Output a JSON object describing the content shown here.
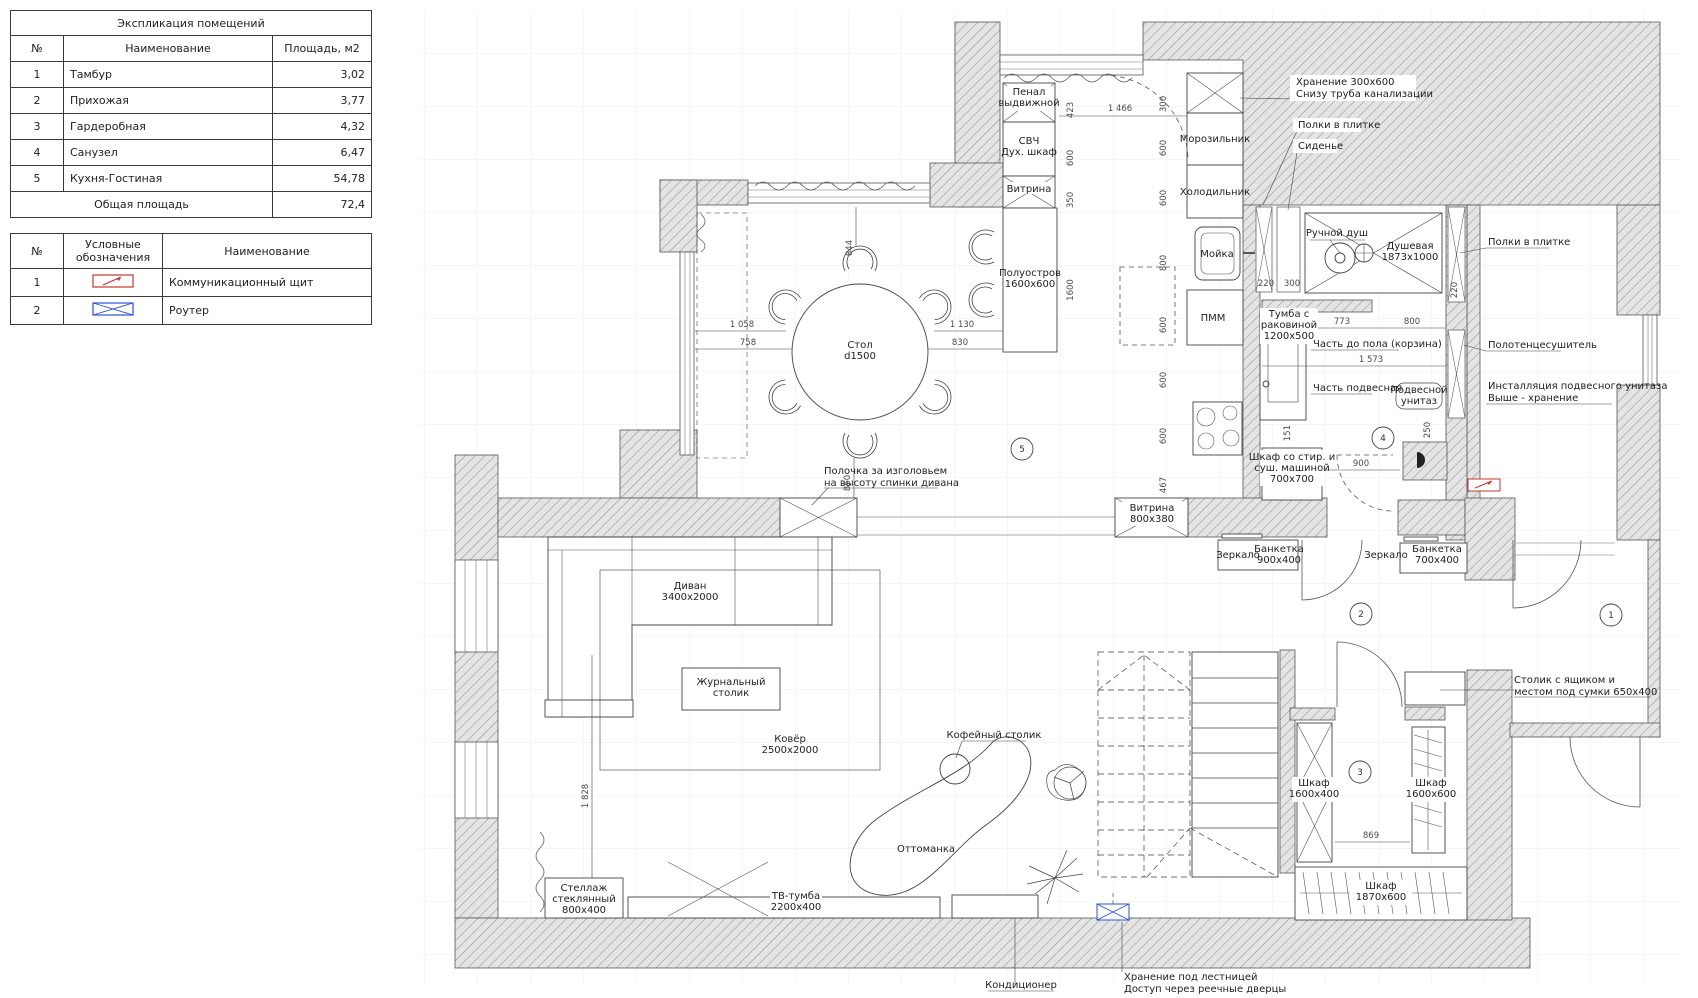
{
  "explication": {
    "title": "Экспликация помещений",
    "col_num": "№",
    "col_name": "Наименование",
    "col_area": "Площадь, м2",
    "rows": [
      {
        "n": "1",
        "name": "Тамбур",
        "area": "3,02"
      },
      {
        "n": "2",
        "name": "Прихожая",
        "area": "3,77"
      },
      {
        "n": "3",
        "name": "Гардеробная",
        "area": "4,32"
      },
      {
        "n": "4",
        "name": "Санузел",
        "area": "6,47"
      },
      {
        "n": "5",
        "name": "Кухня-Гостиная",
        "area": "54,78"
      }
    ],
    "total_label": "Общая площадь",
    "total_value": "72,4"
  },
  "legend": {
    "col_num": "№",
    "col_symbol": "Условные обозначения",
    "col_name": "Наименование",
    "rows": [
      {
        "n": "1",
        "name": "Коммуникационный щит",
        "icon": "comm-panel"
      },
      {
        "n": "2",
        "name": "Роутер",
        "icon": "router"
      }
    ],
    "colors": {
      "comm_panel": "#c0392b",
      "router": "#2e4fd8"
    }
  },
  "plan": {
    "rooms": {
      "r1": "1",
      "r2": "2",
      "r3": "3",
      "r4": "4",
      "r5": "5"
    },
    "labels": {
      "penal_1": "Пенал",
      "penal_2": "выдвижной",
      "svch_1": "СВЧ",
      "svch_2": "Дух. шкаф",
      "vitrina_small": "Витрина",
      "island_1": "Полуостров",
      "island_2": "1600х600",
      "freezer": "Морозильник",
      "fridge": "Холодильник",
      "sink": "Мойка",
      "pmm": "ПММ",
      "storage300_1": "Хранение 300х600",
      "storage300_2": "Снизу труба канализации",
      "shelves_tile_top": "Полки в плитке",
      "seat": "Сиденье",
      "hand_shower": "Ручной душ",
      "shower_1": "Душевая",
      "shower_2": "1873х1000",
      "vanity_1": "Тумба с",
      "vanity_2": "раковиной",
      "vanity_3": "1200х500",
      "part_floor": "Часть до пола (корзина)",
      "part_hung": "Часть подвесная",
      "wc_1": "Подвесной",
      "wc_2": "унитаз",
      "washer_1": "Шкаф со стир. и",
      "washer_2": "суш. машиной",
      "washer_3": "700х700",
      "shelves_tile_right": "Полки в плитке",
      "towel": "Полотенцесушитель",
      "install_1": "Инсталляция подвесного унитаза",
      "install_2": "Выше - хранение",
      "vitrina800_1": "Витрина",
      "vitrina800_2": "800х380",
      "mirror1": "Зеркало",
      "bench900_1": "Банкетка",
      "bench900_2": "900х400",
      "mirror2": "Зеркало",
      "bench700_1": "Банкетка",
      "bench700_2": "700х400",
      "table650_1": "Столик с ящиком и",
      "table650_2": "местом под сумки 650х400",
      "ward1600x400_1": "Шкаф",
      "ward1600x400_2": "1600х400",
      "ward1600x600_1": "Шкаф",
      "ward1600x600_2": "1600х600",
      "ward1870_1": "Шкаф",
      "ward1870_2": "1870х600",
      "sofa_1": "Диван",
      "sofa_2": "3400х2000",
      "jtable_1": "Журнальный",
      "jtable_2": "столик",
      "rug_1": "Ковёр",
      "rug_2": "2500х2000",
      "coffee": "Кофейный столик",
      "ottoman": "Оттоманка",
      "tv_1": "ТВ-тумба",
      "tv_2": "2200х400",
      "shelf_glass_1": "Стеллаж",
      "shelf_glass_2": "стеклянный",
      "shelf_glass_3": "800х400",
      "ac": "Кондиционер",
      "understairs_1": "Хранение под лестницей",
      "understairs_2": "Доступ через реечные дверцы",
      "headboard_1": "Полочка за изголовьем",
      "headboard_2": "на высоту спинки дивана",
      "table_1": "Стол",
      "table_2": "d1500"
    },
    "dims": {
      "d423": "423",
      "d600": "600",
      "d350": "350",
      "d1600": "1600",
      "d1466": "1 466",
      "d300": "300",
      "d800": "800",
      "d467": "467",
      "d220": "220",
      "d773": "773",
      "d1573": "1 573",
      "d151": "151",
      "d900": "900",
      "d250": "250",
      "d869": "869",
      "d844": "844",
      "d1058": "1 058",
      "d758": "758",
      "d1130": "1 130",
      "d830": "830",
      "d850": "850",
      "d1828": "1 828"
    }
  }
}
